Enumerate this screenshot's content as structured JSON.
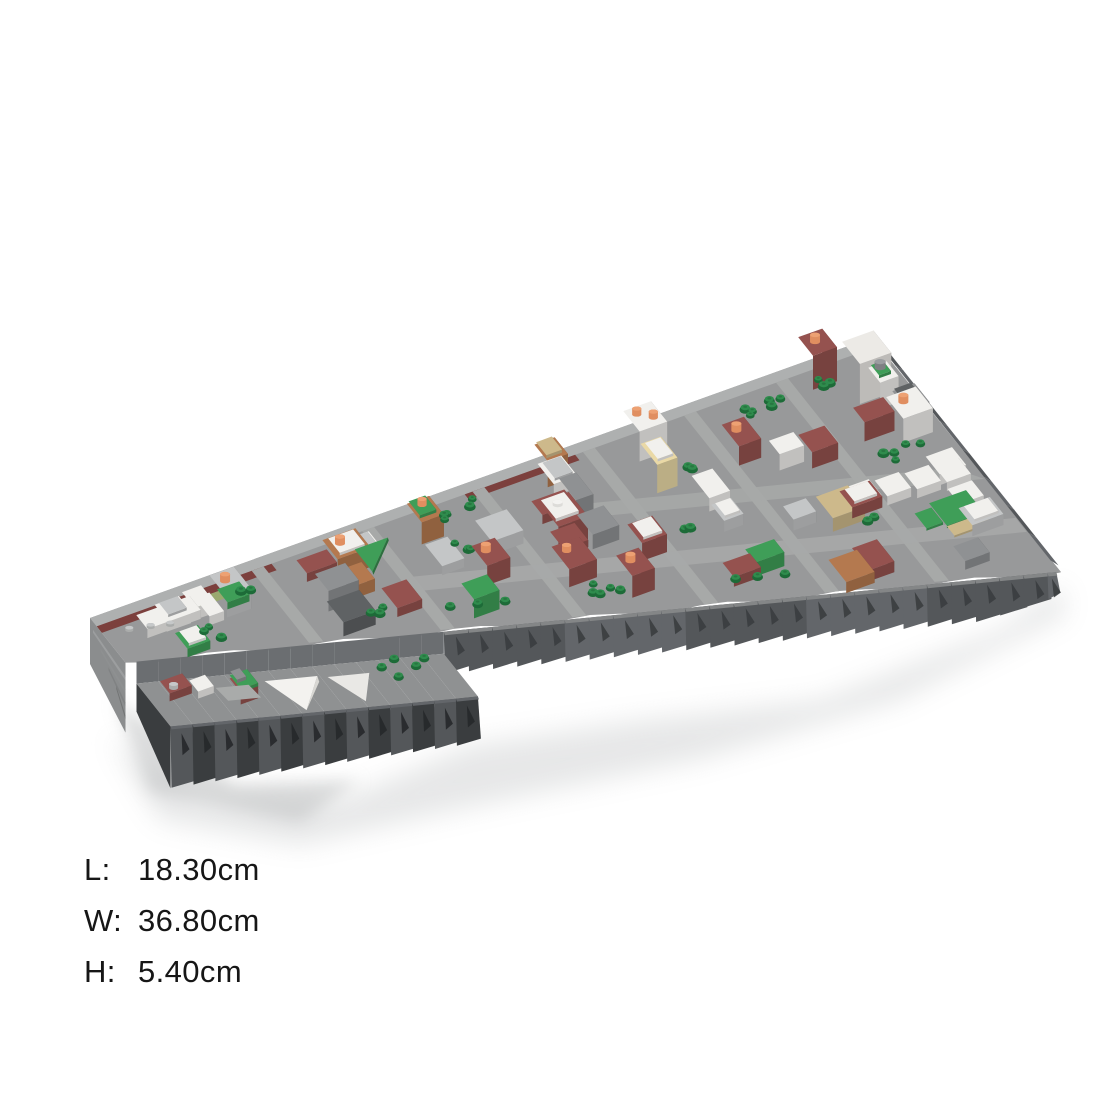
{
  "page": {
    "background_color": "#ffffff"
  },
  "product": {
    "alt": "Brick-built micro-scale city district model, isometric render on white background",
    "kind": "building-block model render"
  },
  "dimensions": {
    "rows": [
      {
        "key": "length",
        "label": "L:",
        "value": "18.30cm"
      },
      {
        "key": "width",
        "label": "W:",
        "value": "36.80cm"
      },
      {
        "key": "height",
        "label": "H:",
        "value": "5.40cm"
      }
    ]
  },
  "palette": {
    "street": "#98999a",
    "street_light": "#a7a9a8",
    "rim": "#aeb0b0",
    "terrace": "#8f9192",
    "ledge": "#6b6e71",
    "cliff": "#54575a",
    "cliff_mid": "#63666a",
    "cliff_deep": "#3a3d3f",
    "cliff_light": "#8b8d8e",
    "white_brick": "#f1f0ed",
    "light_gray_brick": "#c4c6c7",
    "mid_gray_brick": "#8f9193",
    "dark_gray_brick": "#5f6264",
    "dark_red_brick": "#95524f",
    "maroon_stripe": "#7c403d",
    "brown_brick": "#b4794f",
    "tan_brick": "#cdb98b",
    "cream_brick": "#ead9a6",
    "olive_green": "#9aa96f",
    "park_green": "#3f9e58",
    "tree_dark": "#1d6b38",
    "tree_light": "#2f8c4d",
    "orange_tower": "#eda173",
    "orange_tower_body": "#e08e60",
    "gray_tower": "#9b9da0",
    "gray_tower_body": "#7e8083",
    "shadow": "#c9cbcc"
  }
}
